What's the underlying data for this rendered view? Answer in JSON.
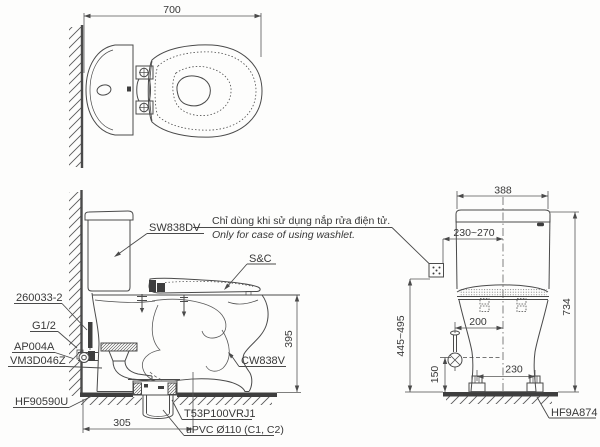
{
  "note": {
    "vi": "Chỉ dùng khi sử dụng nắp rửa điện tử.",
    "en": "Only for case of using washlet."
  },
  "labels": {
    "tank": "SW838DV",
    "tank_bolt": "260033-2",
    "supply_thread": "G1/2",
    "stop_valve": "AP004A",
    "flush_valve": "VM3D046Z",
    "floor_flange": "HF90590U",
    "seat_cover": "S&C",
    "bowl": "CW838V",
    "drain_socket": "T53P100VRJ1",
    "drain_pipe": "uPVC Ø110 (C1, C2)",
    "bolt_set": "HF9A874"
  },
  "dimensions": {
    "plan_depth": "700",
    "side_rough_in": "305",
    "rim_height": "395",
    "rear_width": "388",
    "washlet_range": "230~270",
    "overall_height": "734",
    "supply_height": "445~495",
    "supply_offset": "200",
    "valve_height": "150",
    "bolt_pitch": "230"
  }
}
